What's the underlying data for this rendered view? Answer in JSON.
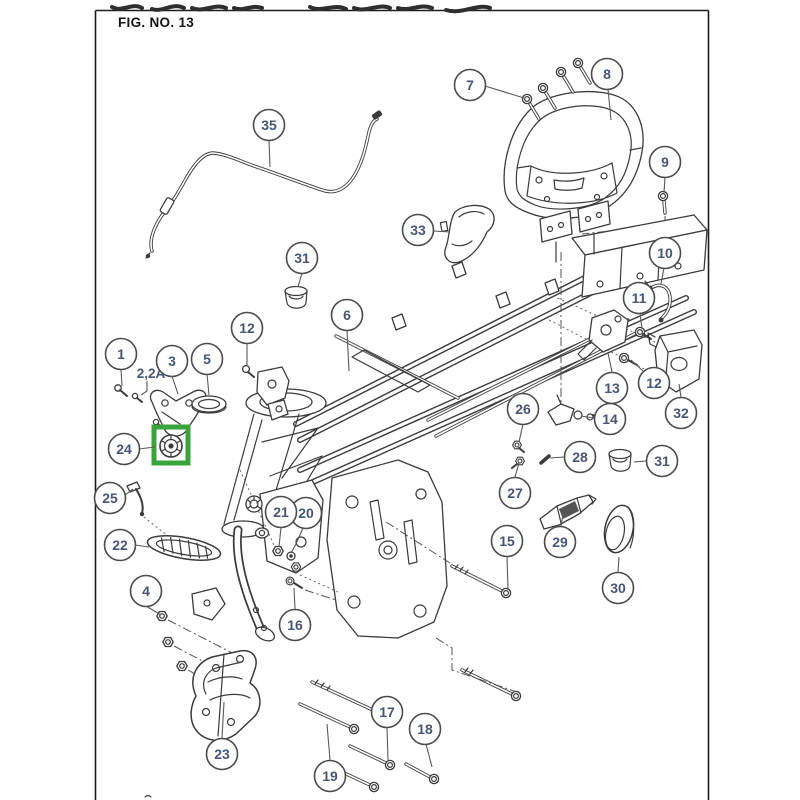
{
  "figure": {
    "title": "FIG. NO. 13"
  },
  "labels": {
    "variant_2_2a": "2,2A"
  },
  "style": {
    "number_color": "#4a5573",
    "leader_color": "#5a5a5a",
    "line_color": "#3b3b3b"
  },
  "highlight": {
    "color": "#3aa33c",
    "part_ref": "24"
  },
  "callouts": [
    {
      "label": "1",
      "x": 121,
      "y": 354,
      "leader": [
        [
          121,
          369
        ],
        [
          122,
          386
        ]
      ]
    },
    {
      "label": "3",
      "x": 172,
      "y": 361,
      "leader": [
        [
          172,
          376
        ],
        [
          178,
          394
        ]
      ]
    },
    {
      "label": "4",
      "x": 146,
      "y": 591,
      "leader": [
        [
          146,
          606
        ],
        [
          161,
          615
        ]
      ]
    },
    {
      "label": "5",
      "x": 207,
      "y": 359,
      "leader": [
        [
          207,
          374
        ],
        [
          209,
          395
        ]
      ]
    },
    {
      "label": "6",
      "x": 347,
      "y": 315,
      "leader": [
        [
          347,
          330
        ],
        [
          349,
          371
        ]
      ]
    },
    {
      "label": "7",
      "x": 470,
      "y": 85,
      "leader": [
        [
          485,
          86
        ],
        [
          524,
          98
        ]
      ]
    },
    {
      "label": "8",
      "x": 607,
      "y": 74,
      "leader": [
        [
          608,
          89
        ],
        [
          611,
          120
        ]
      ]
    },
    {
      "label": "9",
      "x": 665,
      "y": 162,
      "leader": [
        [
          665,
          177
        ],
        [
          664,
          193
        ]
      ]
    },
    {
      "label": "10",
      "x": 665,
      "y": 253,
      "leader": [
        [
          664,
          268
        ],
        [
          661,
          284
        ]
      ]
    },
    {
      "label": "11",
      "x": 639,
      "y": 298,
      "leader": [
        [
          640,
          313
        ],
        [
          642,
          329
        ]
      ]
    },
    {
      "label": "12",
      "x": 247,
      "y": 328,
      "leader": [
        [
          247,
          343
        ],
        [
          247,
          365
        ]
      ]
    },
    {
      "label": "12",
      "x": 654,
      "y": 383,
      "leader": [
        [
          643,
          371
        ],
        [
          631,
          360
        ]
      ]
    },
    {
      "label": "13",
      "x": 612,
      "y": 388,
      "leader": [
        [
          612,
          372
        ],
        [
          608,
          353
        ]
      ]
    },
    {
      "label": "14",
      "x": 610,
      "y": 419,
      "leader": [
        [
          594,
          418
        ],
        [
          581,
          416
        ]
      ]
    },
    {
      "label": "15",
      "x": 507,
      "y": 541,
      "leader": [
        [
          507,
          556
        ],
        [
          508,
          590
        ]
      ]
    },
    {
      "label": "16",
      "x": 295,
      "y": 625,
      "leader": [
        [
          295,
          609
        ],
        [
          294,
          588
        ]
      ]
    },
    {
      "label": "17",
      "x": 387,
      "y": 712,
      "leader": [
        [
          387,
          727
        ],
        [
          388,
          760
        ]
      ]
    },
    {
      "label": "18",
      "x": 425,
      "y": 729,
      "leader": [
        [
          426,
          744
        ],
        [
          432,
          767
        ]
      ]
    },
    {
      "label": "19",
      "x": 330,
      "y": 776,
      "leader": [
        [
          330,
          760
        ],
        [
          327,
          724
        ]
      ]
    },
    {
      "label": "20",
      "x": 306,
      "y": 513,
      "leader": [
        [
          303,
          528
        ],
        [
          296,
          544
        ],
        [
          291,
          553
        ]
      ]
    },
    {
      "label": "21",
      "x": 281,
      "y": 512,
      "leader": [
        [
          281,
          527
        ],
        [
          279,
          547
        ]
      ]
    },
    {
      "label": "22",
      "x": 120,
      "y": 545,
      "leader": [
        [
          135,
          545
        ],
        [
          149,
          547
        ]
      ]
    },
    {
      "label": "23",
      "x": 222,
      "y": 754,
      "leader": [
        [
          222,
          738
        ],
        [
          224,
          702
        ]
      ]
    },
    {
      "label": "24",
      "x": 124,
      "y": 449,
      "leader": [
        [
          139,
          449
        ],
        [
          155,
          447
        ]
      ]
    },
    {
      "label": "25",
      "x": 110,
      "y": 498,
      "leader": [
        [
          125,
          495
        ],
        [
          133,
          489
        ]
      ]
    },
    {
      "label": "26",
      "x": 523,
      "y": 409,
      "leader": [
        [
          523,
          424
        ],
        [
          519,
          442
        ]
      ]
    },
    {
      "label": "27",
      "x": 515,
      "y": 493,
      "leader": [
        [
          515,
          477
        ],
        [
          519,
          463
        ]
      ]
    },
    {
      "label": "28",
      "x": 580,
      "y": 457,
      "leader": [
        [
          564,
          457
        ],
        [
          550,
          458
        ]
      ]
    },
    {
      "label": "29",
      "x": 560,
      "y": 542,
      "leader": [
        [
          561,
          527
        ],
        [
          563,
          513
        ]
      ]
    },
    {
      "label": "30",
      "x": 618,
      "y": 588,
      "leader": [
        [
          618,
          572
        ],
        [
          619,
          557
        ]
      ]
    },
    {
      "label": "31",
      "x": 302,
      "y": 258,
      "leader": [
        [
          302,
          273
        ],
        [
          298,
          287
        ]
      ]
    },
    {
      "label": "31",
      "x": 662,
      "y": 461,
      "leader": [
        [
          646,
          461
        ],
        [
          634,
          462
        ]
      ]
    },
    {
      "label": "32",
      "x": 681,
      "y": 413,
      "leader": [
        [
          681,
          397
        ],
        [
          679,
          384
        ]
      ]
    },
    {
      "label": "33",
      "x": 418,
      "y": 230,
      "leader": [
        [
          433,
          231
        ],
        [
          450,
          232
        ]
      ]
    },
    {
      "label": "35",
      "x": 269,
      "y": 125,
      "leader": [
        [
          269,
          140
        ],
        [
          270,
          167
        ]
      ]
    }
  ]
}
